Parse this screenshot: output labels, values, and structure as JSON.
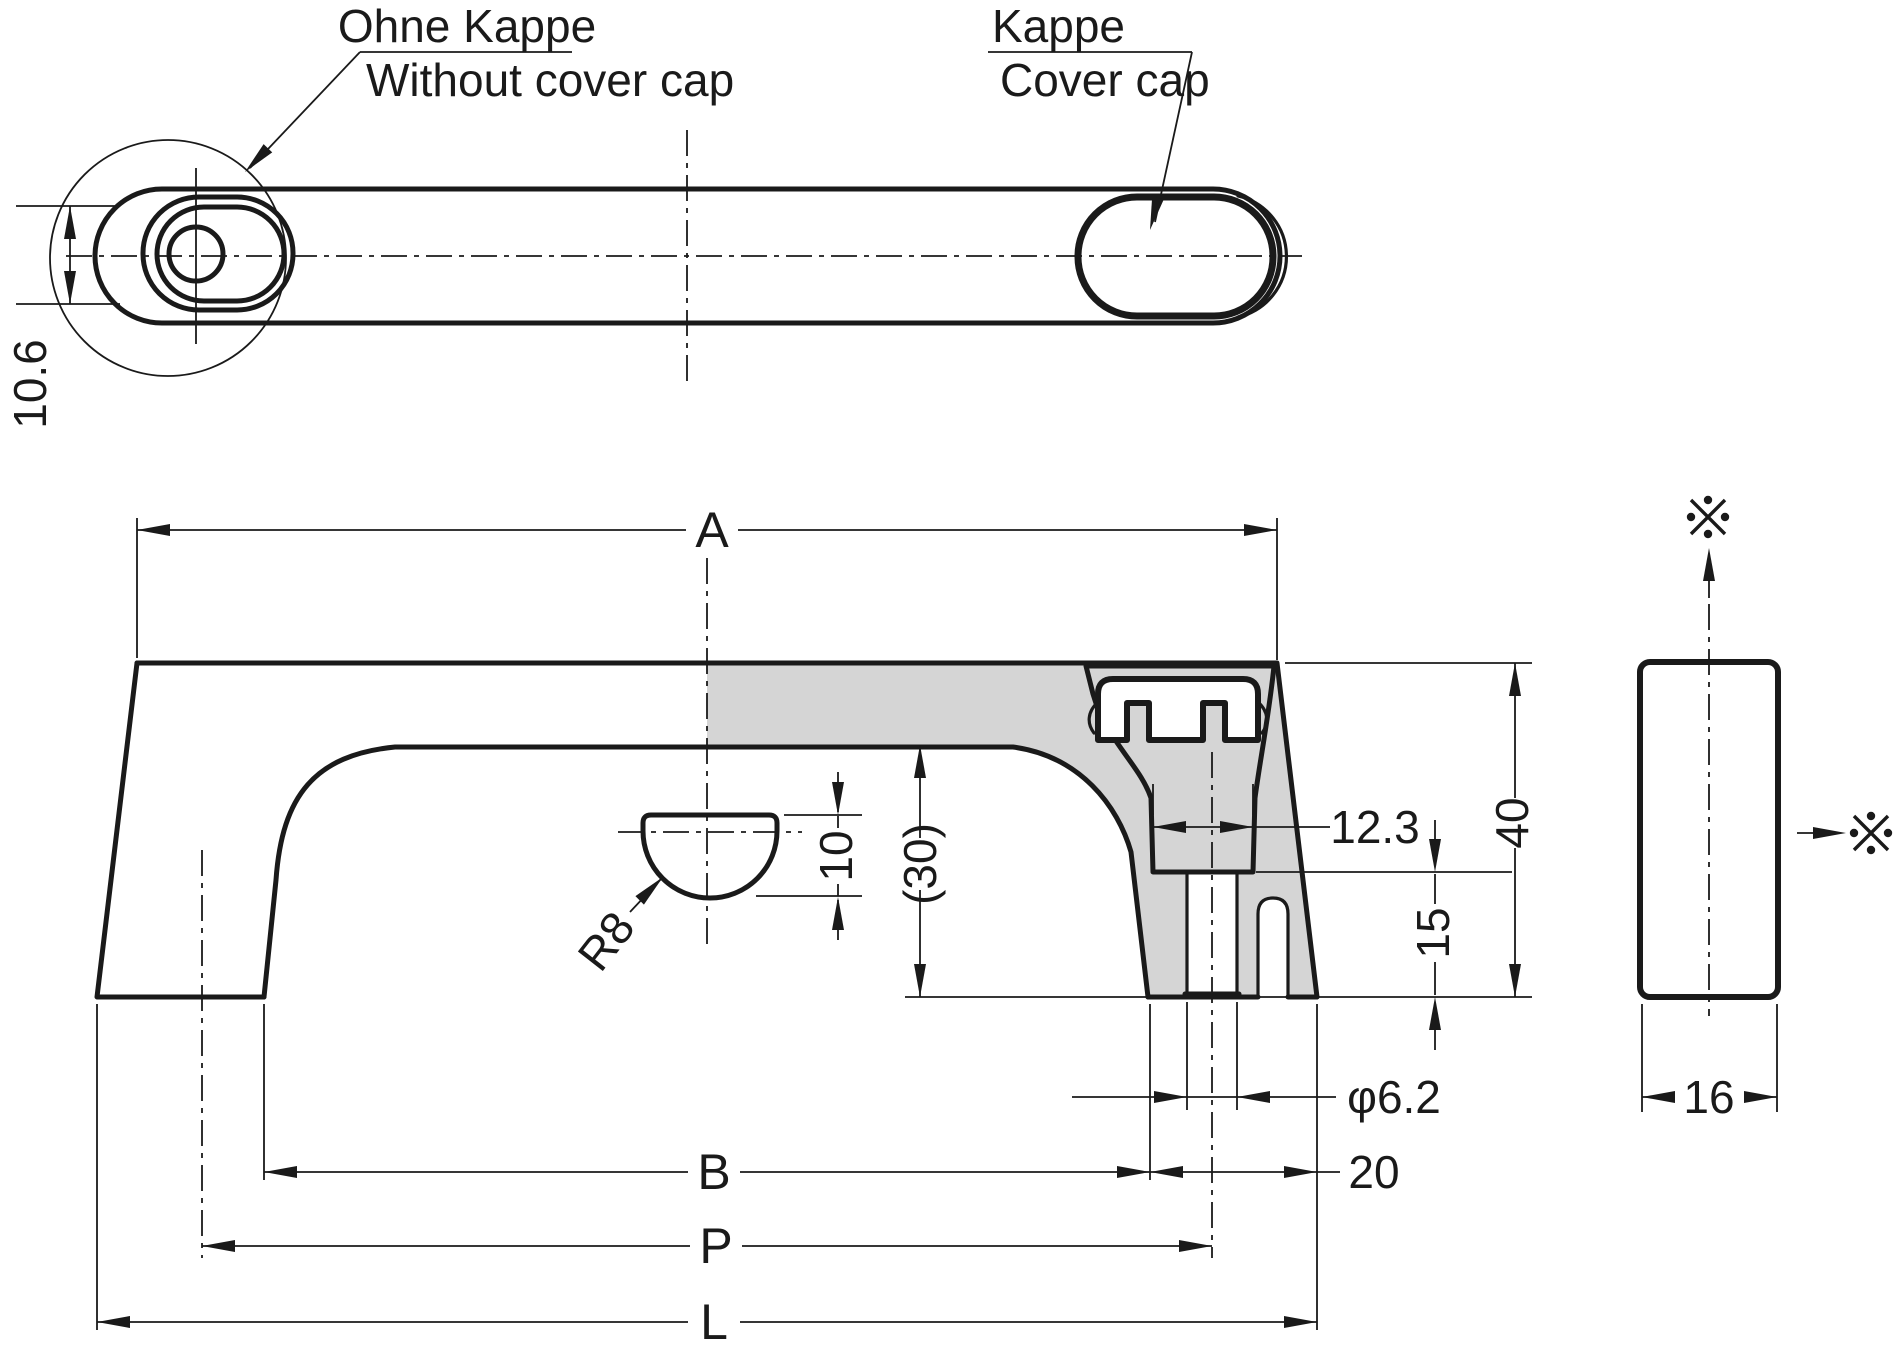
{
  "drawing": {
    "callouts": {
      "ohne_kappe": "Ohne Kappe",
      "without_cover_cap": "Without cover cap",
      "kappe": "Kappe",
      "cover_cap": "Cover cap"
    },
    "dimensions": {
      "recess_width": "10.6",
      "length_a": "A",
      "pocket_width": "12.3",
      "overall_height": "40",
      "foot_height": "15",
      "inner_clearance": "(30)",
      "boss_height": "10",
      "boss_radius": "R8",
      "hole_diameter": "φ6.2",
      "foot_width": "20",
      "inner_span_b": "B",
      "hole_pitch_p": "P",
      "overall_length_l": "L",
      "profile_depth": "16"
    },
    "symbols": {
      "reference_mark": "※"
    },
    "colors": {
      "line": "#1a1a1a",
      "section_fill": "#d5d5d5",
      "background": "#ffffff"
    }
  }
}
